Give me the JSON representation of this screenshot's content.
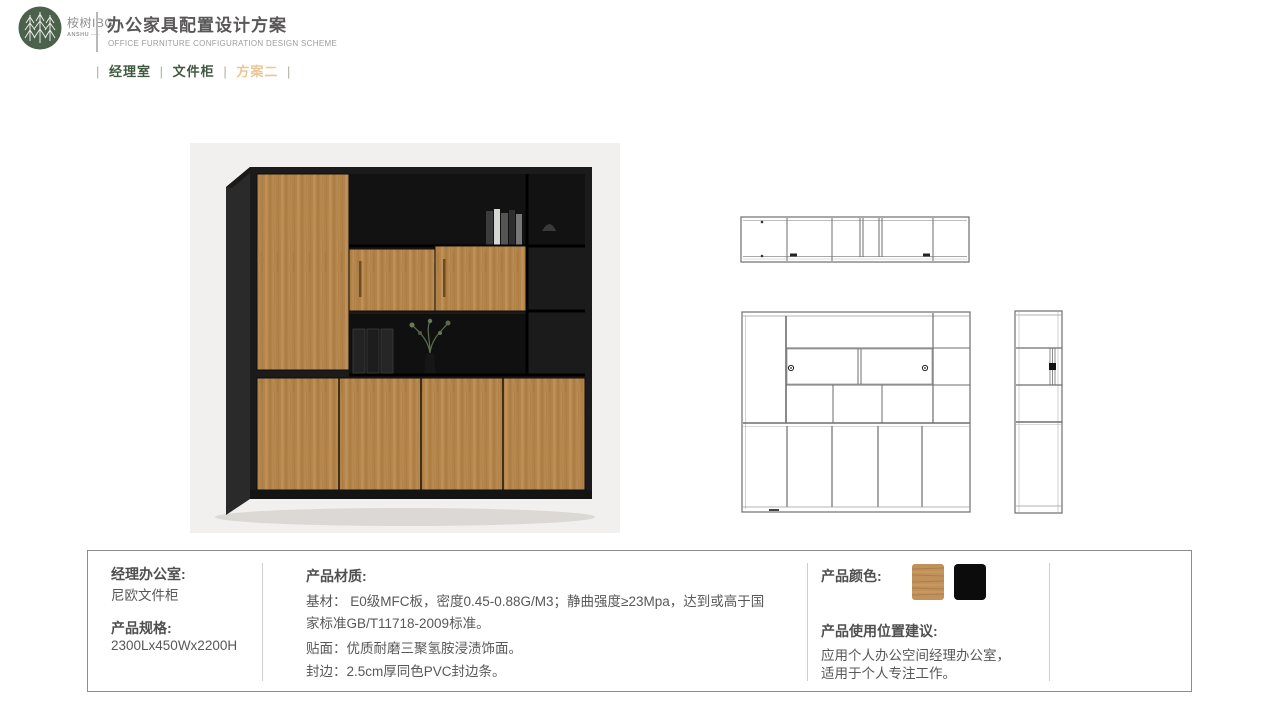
{
  "header": {
    "brand_cn": "桉树IBC",
    "brand_en": "ANSHU",
    "title": "办公家具配置设计方案",
    "subtitle": "OFFICE FURNITURE CONFIGURATION DESIGN SCHEME",
    "tab_separator": "|",
    "tabs": [
      {
        "label": "经理室",
        "color": "#3f5a40"
      },
      {
        "label": "文件柜",
        "color": "#3f5a40"
      },
      {
        "label": "方案二",
        "color": "#eac795"
      }
    ]
  },
  "panel": {
    "room": {
      "label": "经理办公室:",
      "value": "尼欧文件柜"
    },
    "spec": {
      "label": "产品规格:",
      "value": "2300Lx450Wx2200H"
    },
    "material": {
      "title": "产品材质:",
      "line1": "基材： E0级MFC板，密度0.45-0.88G/M3；静曲强度≥23Mpa，达到或高于国家标准GB/T11718-2009标准。",
      "line2": "贴面：优质耐磨三聚氢胺浸渍饰面。",
      "line3": "封边：2.5cm厚同色PVC封边条。"
    },
    "colors": {
      "title": "产品颜色:",
      "swatches": [
        {
          "name": "wood",
          "hex": "#c0915a"
        },
        {
          "name": "black",
          "hex": "#0c0c0c"
        }
      ]
    },
    "usage": {
      "title": "产品使用位置建议:",
      "line1": "应用个人办公空间经理办公室，",
      "line2": "适用于个人专注工作。"
    }
  },
  "palette": {
    "accent_green": "#3f5a40",
    "accent_tan": "#eac795",
    "body_text": "#595757",
    "drawing_line": "#6e6e6e",
    "wood": "#b5854a",
    "cabinet_black": "#1b1b1b",
    "render_background": "#f1f0ee"
  }
}
